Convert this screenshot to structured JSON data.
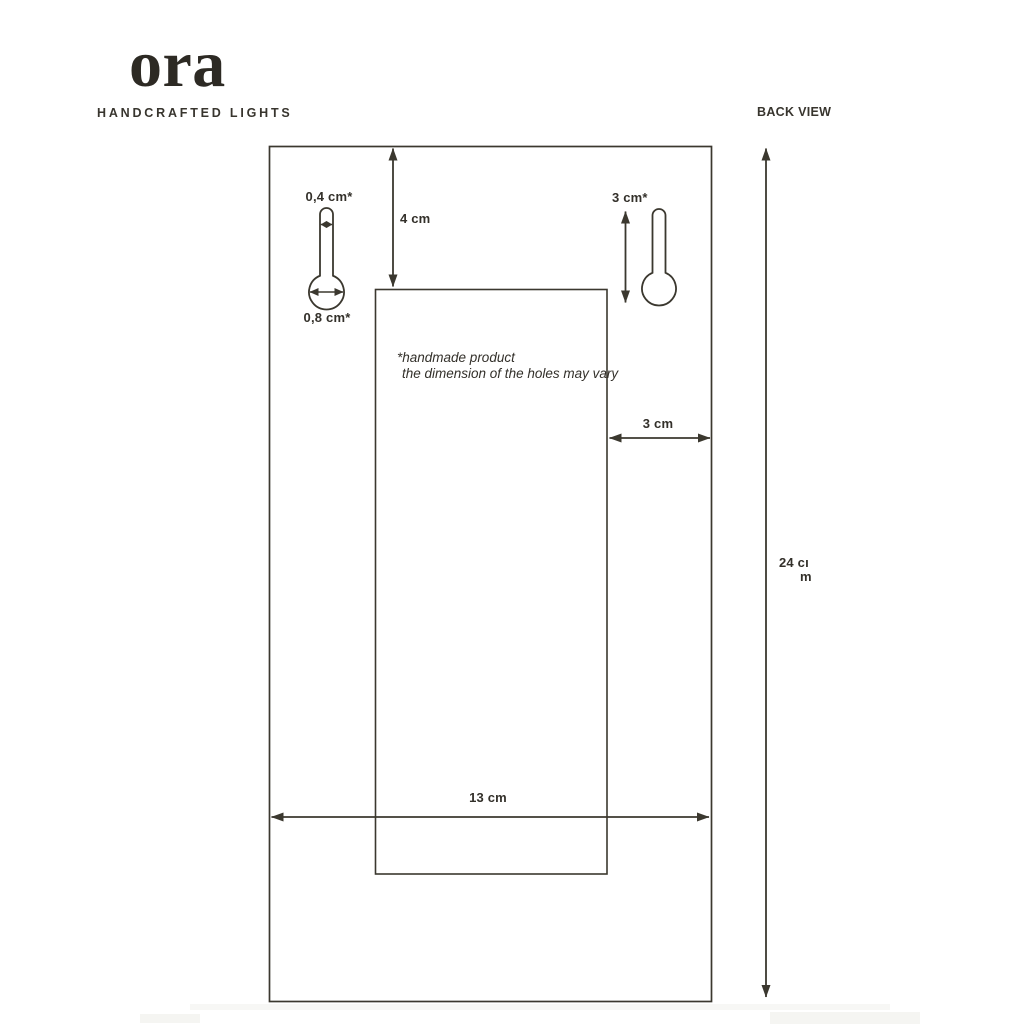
{
  "brand": {
    "name": "ora",
    "tagline": "HANDCRAFTED LIGHTS"
  },
  "view_label": "BACK VIEW",
  "annotations": {
    "note_line1": "*handmade product",
    "note_line2": "the dimension of the holes may vary"
  },
  "dimensions": {
    "slot_width": "0,4 cm*",
    "hole_width": "0,8 cm*",
    "top_offset": "4 cm",
    "keyhole_height": "3 cm*",
    "side_offset": "3 cm",
    "panel_width": "13 cm",
    "panel_height": "24 cm",
    "panel_height_wrap_line1": "24 cı",
    "panel_height_wrap_line2": "m"
  },
  "colors": {
    "ink": "#3b382f",
    "text": "#33302a",
    "background": "#ffffff",
    "artifact": "#f5f5f2"
  }
}
